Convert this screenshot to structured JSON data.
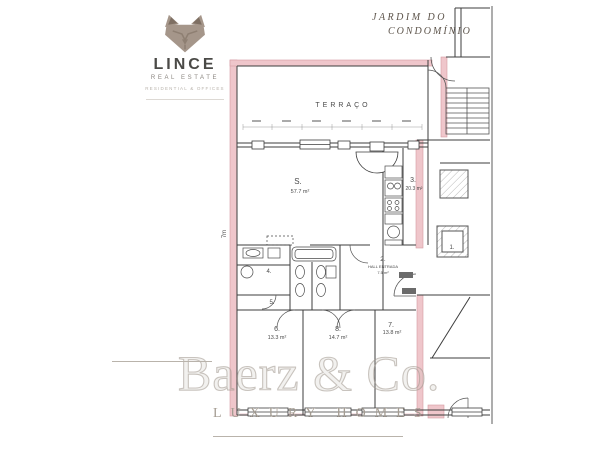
{
  "logo": {
    "brand": "LINCE",
    "subtitle": "REAL ESTATE",
    "tagline": "RESIDENTIAL & OFFICES"
  },
  "annotation": {
    "line1": "JARDIM DO",
    "line2": "CONDOMÍNIO"
  },
  "plan": {
    "terrace_label": "TERRAÇO",
    "left_dimension": "7m",
    "rooms": [
      {
        "id": "living",
        "label": "S.",
        "area": "57.7 m²"
      },
      {
        "id": "room3",
        "label": "3.",
        "area": "20.3 m²"
      },
      {
        "id": "hall",
        "label": "2.",
        "name": "HALL ENTRADA",
        "area": "7.5 m²"
      },
      {
        "id": "wc4",
        "label": "4."
      },
      {
        "id": "wc5",
        "label": "5."
      },
      {
        "id": "bed6",
        "label": "6.",
        "area": "13.3 m²"
      },
      {
        "id": "bed8",
        "label": "8.",
        "area": "14.7 m²"
      },
      {
        "id": "bed7",
        "label": "7.",
        "area": "13.8 m²"
      },
      {
        "id": "elevator",
        "label": "1."
      }
    ],
    "colors": {
      "wall_highlight": "#efc6cb",
      "wall_highlight_stroke": "#d49ba2",
      "line": "#3d3d3d"
    }
  },
  "watermark": {
    "name": "Baerz & Co.",
    "tagline": "LUXURY HOMES"
  }
}
